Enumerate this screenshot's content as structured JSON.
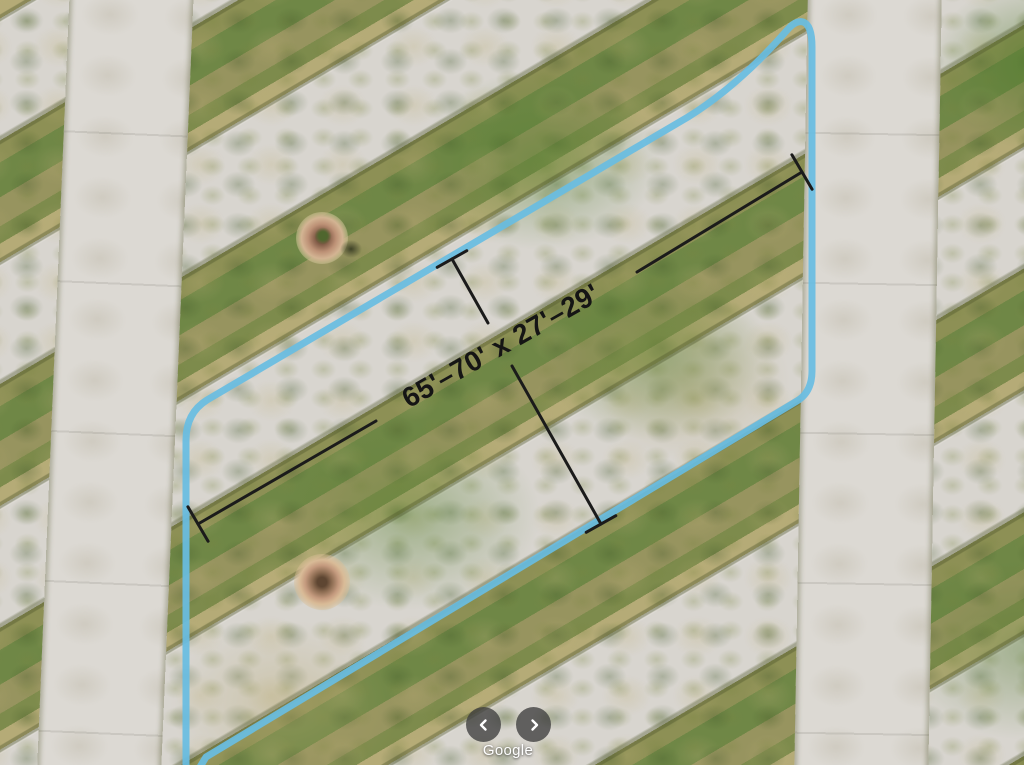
{
  "map": {
    "type": "satellite-aerial-imagery",
    "features": {
      "property_outline": {
        "shape": "parallelogram-with-rounded-corners",
        "color": "#68bde2"
      },
      "dimension_annotation": {
        "label": "65'–70' x 27'–29'",
        "length_range_ft": "65-70",
        "width_range_ft": "27-29",
        "line_color": "#1b1b1b"
      }
    }
  },
  "controls": {
    "prev_icon": "chevron-left",
    "next_icon": "chevron-right"
  },
  "watermark": {
    "text": "Google"
  }
}
